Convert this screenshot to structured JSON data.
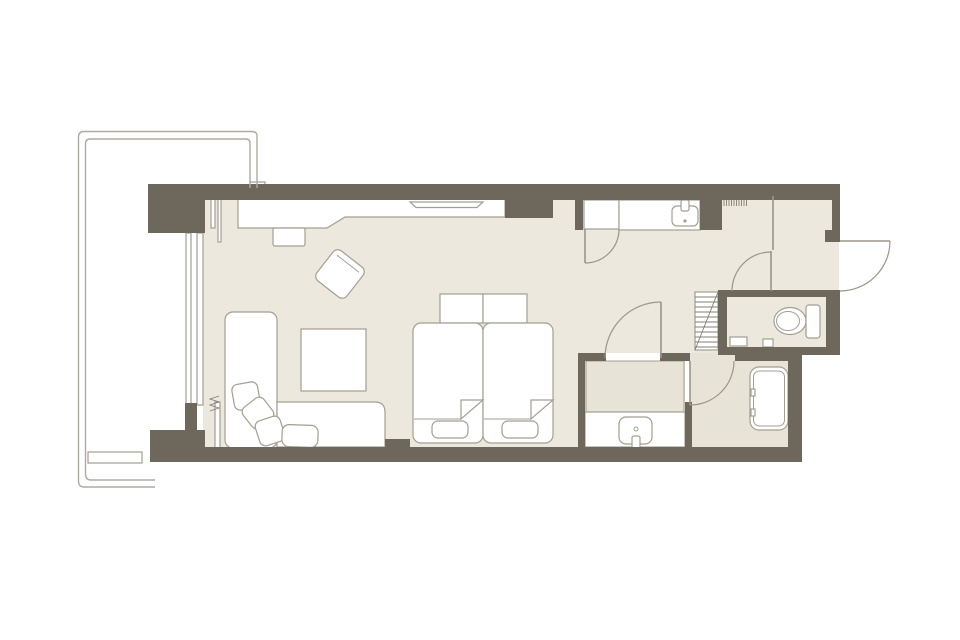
{
  "floor_plan": {
    "kind": "hotel-guest-room-floor-plan",
    "colors": {
      "background": "#ffffff",
      "wall": "#6e675c",
      "floor": "#ece8dd",
      "wet_floor": "#e8e3d7",
      "fixture_fill": "#ffffff",
      "fixture_outline": "#a49e93",
      "door_arc": "#9b958a",
      "balcony_rail": "#b0aaa0"
    },
    "rooms": [
      {
        "name": "bedroom-living-area"
      },
      {
        "name": "corridor-vanity-area"
      },
      {
        "name": "entry-hall"
      },
      {
        "name": "toilet-room"
      },
      {
        "name": "washroom"
      },
      {
        "name": "bathroom-with-tub"
      },
      {
        "name": "balcony"
      }
    ],
    "furniture": [
      {
        "name": "desk-counter"
      },
      {
        "name": "wall-tv"
      },
      {
        "name": "desk-stool"
      },
      {
        "name": "lounge-armchair"
      },
      {
        "name": "chaise-daybed"
      },
      {
        "name": "sofa"
      },
      {
        "name": "cushions",
        "count": 4
      },
      {
        "name": "coffee-table"
      },
      {
        "name": "twin-bed",
        "count": 2
      },
      {
        "name": "bed-head-cushion",
        "count": 2
      },
      {
        "name": "bed-foot-pillow",
        "count": 2
      },
      {
        "name": "closet"
      },
      {
        "name": "vanity-counter-with-sink"
      },
      {
        "name": "luggage-rack-hatch"
      },
      {
        "name": "linen-shelf"
      },
      {
        "name": "toilet"
      },
      {
        "name": "washroom-vanity-sink"
      },
      {
        "name": "bathtub"
      }
    ],
    "doors": [
      {
        "name": "closet-door",
        "type": "swing"
      },
      {
        "name": "corridor-door",
        "type": "swing"
      },
      {
        "name": "entry-door",
        "type": "swing-outward"
      },
      {
        "name": "washroom-door",
        "type": "swing"
      },
      {
        "name": "shower-room-door",
        "type": "swing"
      }
    ]
  }
}
